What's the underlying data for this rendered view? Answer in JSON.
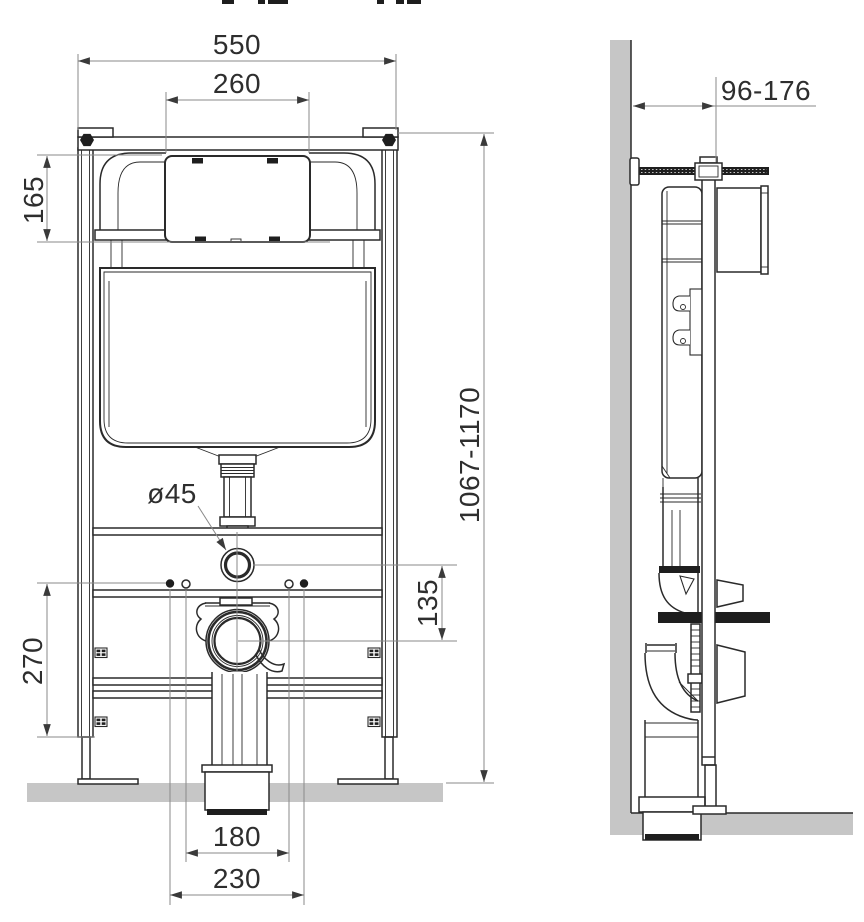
{
  "page": {
    "background": "#ffffff"
  },
  "drawing": {
    "type": "wc-installation-frame-technical-drawing",
    "front_view": {
      "dimensions": {
        "overall_width": "550",
        "panel_width": "260",
        "panel_height": "165",
        "overall_height": "1067-1170",
        "supply_hole_diameter": "ø45",
        "supply_to_outlet_offset": "135",
        "lower_fixing_height": "270",
        "inner_stud_spacing": "180",
        "outer_stud_spacing": "230"
      }
    },
    "side_view": {
      "dimensions": {
        "depth_adjustment": "96-176"
      }
    },
    "style": {
      "line_color": "#2a2a2a",
      "dim_line_color": "#8a8a8a",
      "arrow_color": "#3a3a3a",
      "text_color": "#2e2e2e",
      "wall_floor_fill": "#c6c6c6",
      "background": "#ffffff"
    }
  }
}
